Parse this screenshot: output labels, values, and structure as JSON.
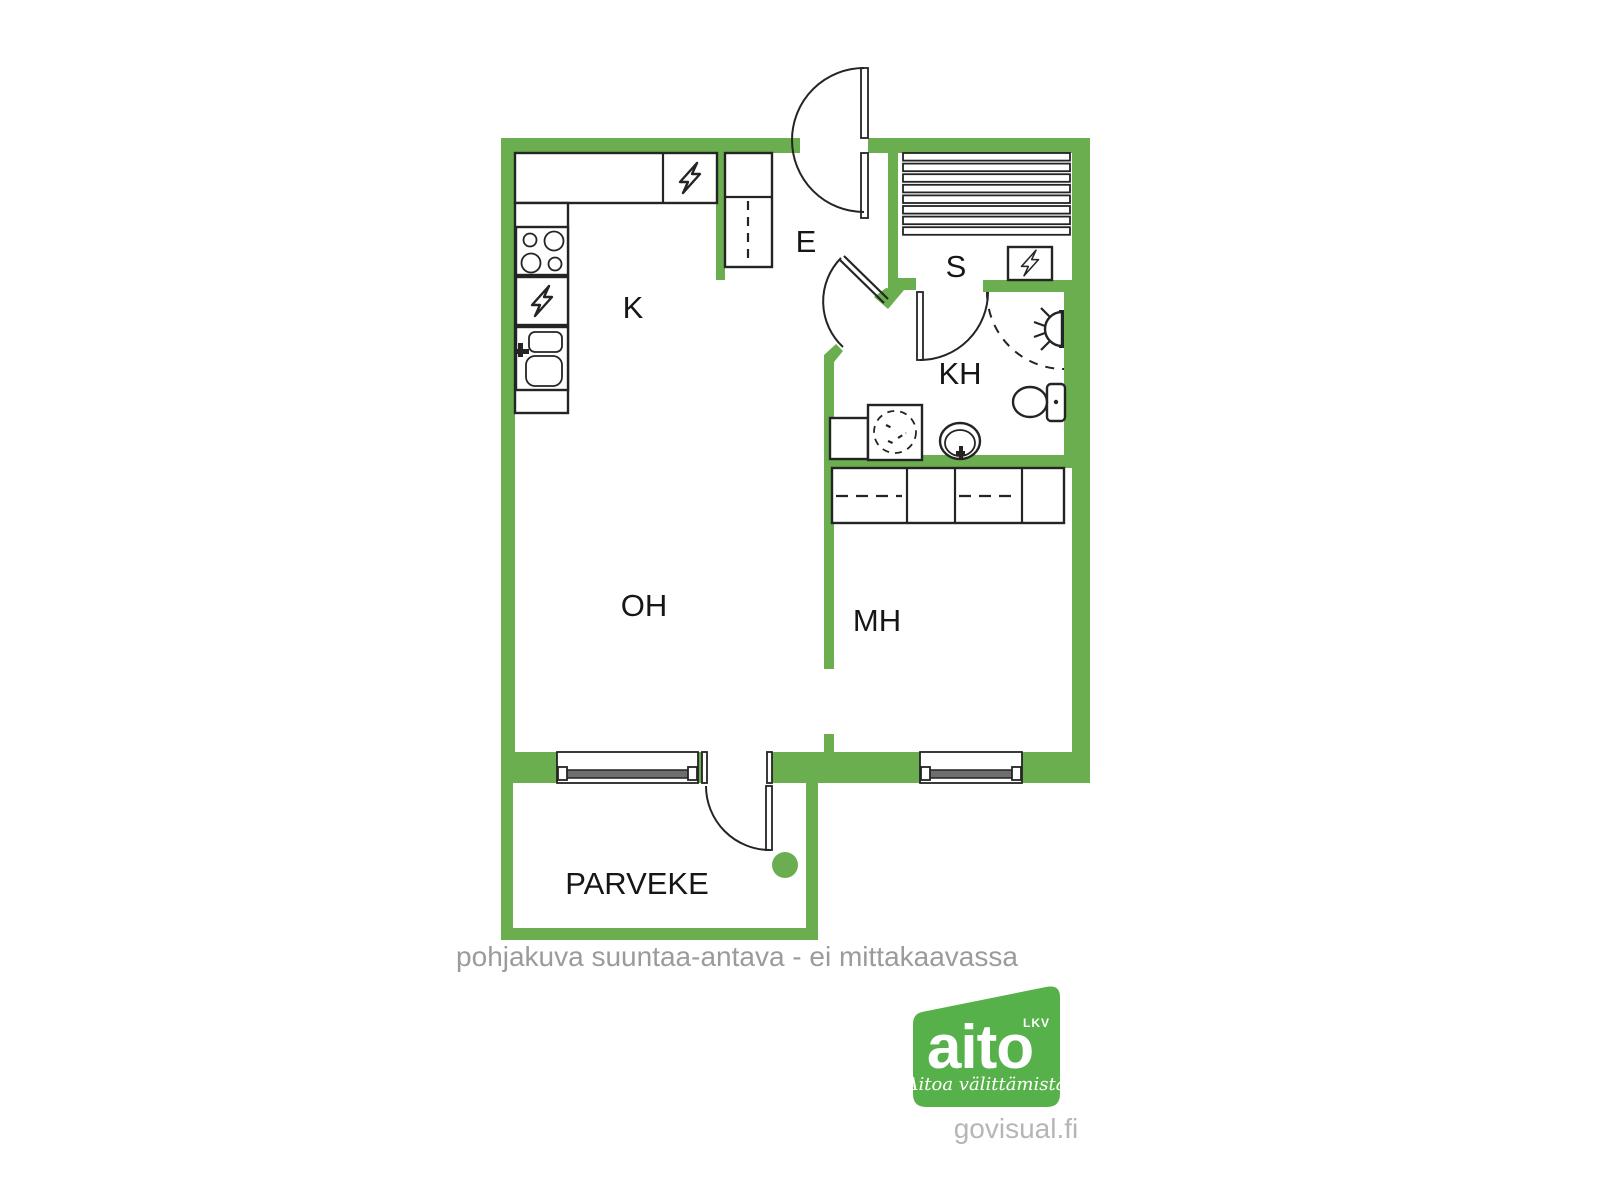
{
  "colors": {
    "wall": "#6BAE4F",
    "logo": "#57B14A",
    "label": "#161616",
    "muted_text": "#9B9B9B",
    "credit_text": "#B6B6B6",
    "glass": "#6E6E6E",
    "logo_text": "#FFFFFF"
  },
  "rooms": {
    "kitchen": "K",
    "entrance": "E",
    "sauna": "S",
    "bathroom": "KH",
    "living_room": "OH",
    "bedroom": "MH",
    "balcony": "PARVEKE"
  },
  "disclaimer": "pohjakuva suuntaa-antava - ei mittakaavassa",
  "logo": {
    "brand": "aito",
    "suffix": "LKV",
    "tagline": "Aitoa välittämistä"
  },
  "credit": "govisual.fi",
  "icons": [
    "stove-icon",
    "dishwasher-icon",
    "kitchen-sink-icon",
    "fridge-icon",
    "tall-cabinet-icon",
    "sauna-bench-icon",
    "sauna-heater-icon",
    "shower-icon",
    "toilet-icon",
    "washing-machine-icon",
    "basin-icon",
    "window-icon",
    "door-swing-icon",
    "balcony-dot-icon"
  ]
}
